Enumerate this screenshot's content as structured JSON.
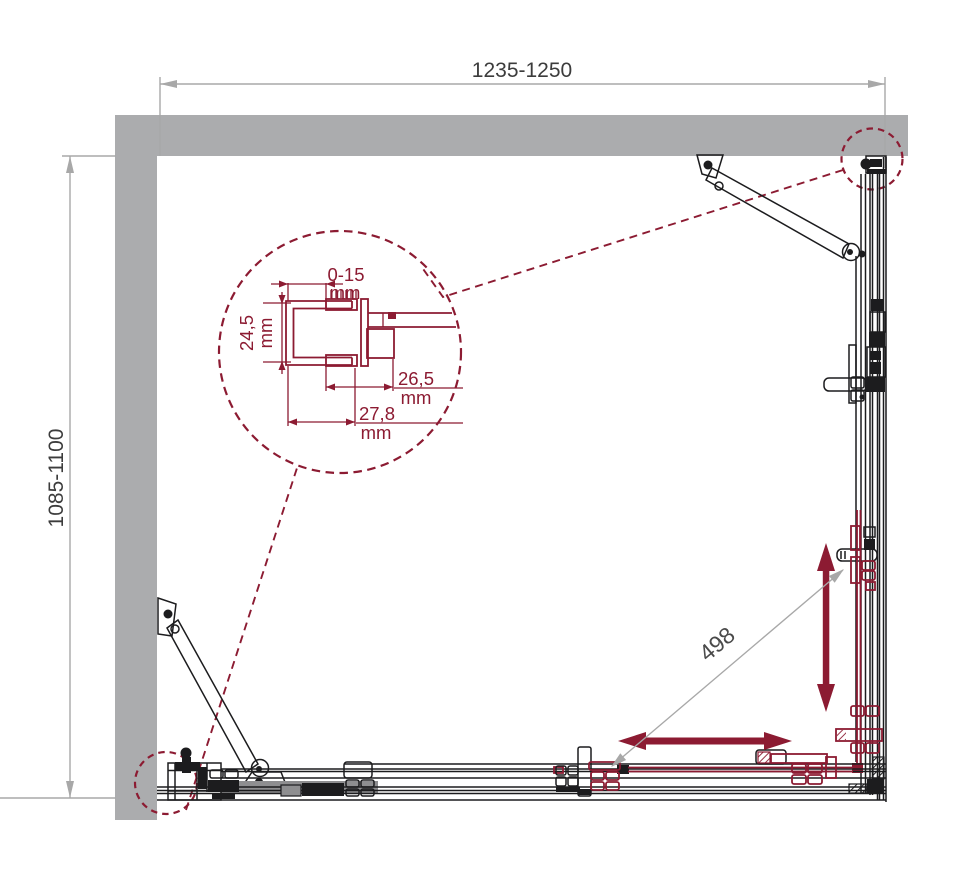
{
  "drawing": {
    "dimensions": {
      "width": {
        "label": "1235-1250"
      },
      "depth": {
        "label": "1085-1100"
      },
      "entry_diagonal": {
        "label": "498"
      }
    },
    "detail_callout": {
      "wall_gap": {
        "value": "0-15",
        "unit": "mm"
      },
      "profile_depth": {
        "value": "24,5",
        "unit": "mm"
      },
      "profile_inner_width": {
        "value": "26,5",
        "unit": "mm"
      },
      "profile_outer_width": {
        "value": "27,8",
        "unit": "mm"
      }
    },
    "colors": {
      "accent": "#8C1B32",
      "wall": "#ABACAE",
      "track": "#8E8E90",
      "line": "#1C1C1E",
      "dim-line": "#A8A8A8",
      "dim-text": "#3C3C3C"
    }
  }
}
